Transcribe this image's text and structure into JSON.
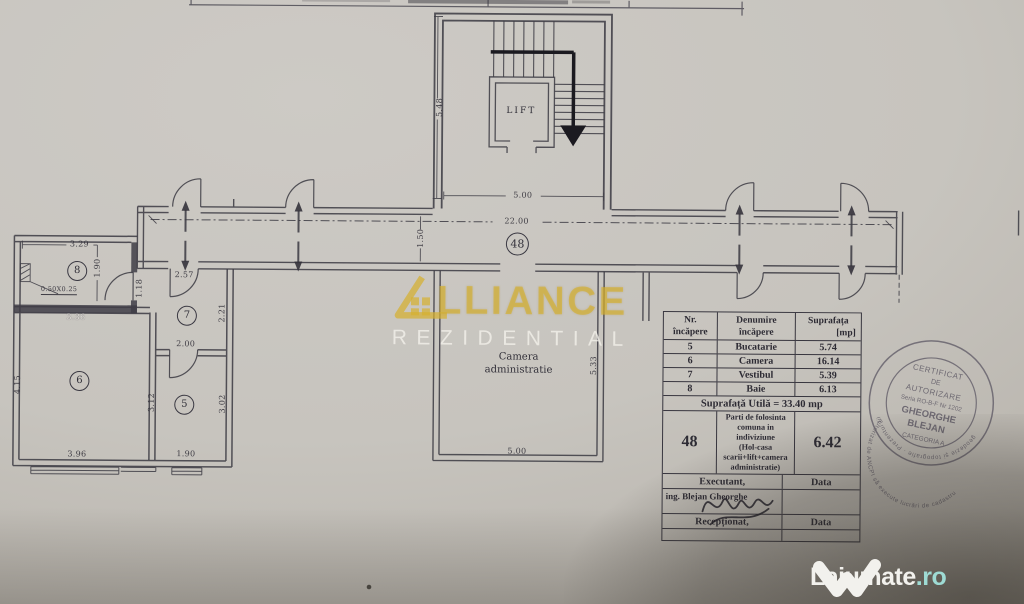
{
  "plan": {
    "lift_label": "LIFT",
    "common_number": "48",
    "admin_room": {
      "line1": "Camera",
      "line2": "administratie"
    },
    "rooms": {
      "r8": "8",
      "r7": "7",
      "r6": "6",
      "r5": "5"
    },
    "dims": {
      "stair_height": "5.48",
      "stair_width": "5.00",
      "corridor_length": "22.00",
      "corridor_width": "1.50",
      "admin_width": "5.00",
      "admin_height": "5.33",
      "r8_top": "3.29",
      "r8_side": "1.90",
      "r8_window": "0.50X0.25",
      "r8_bottom": "3.36",
      "r7_top": "2.57",
      "r7_left": "1.18",
      "r7_right": "2.21",
      "r7_bottom": "2.00",
      "r6_left": "4.15",
      "r6_bottom": "3.96",
      "r5_left": "3.12",
      "r5_right": "3.02",
      "r5_bottom": "1.90"
    }
  },
  "table": {
    "header": {
      "col1_line1": "Nr.",
      "col1_line2": "încăpere",
      "col2_line1": "Denumire",
      "col2_line2": "încăpere",
      "col3_line1": "Suprafața",
      "col3_line2": "[mp]"
    },
    "rows": [
      {
        "nr": "5",
        "name": "Bucatarie",
        "area": "5.74"
      },
      {
        "nr": "6",
        "name": "Camera",
        "area": "16.14"
      },
      {
        "nr": "7",
        "name": "Vestibul",
        "area": "5.39"
      },
      {
        "nr": "8",
        "name": "Baie",
        "area": "6.13"
      }
    ],
    "total": "Suprafață Utilă = 33.40 mp",
    "common": {
      "nr": "48",
      "desc_lines": [
        "Parti de folosinta",
        "comuna in",
        "indiviziune",
        "(Hol-casa",
        "scarii+lift+camera",
        "administratie)"
      ],
      "area": "6.42"
    },
    "footer": {
      "executant": "Executant,",
      "data_label1": "Data",
      "engineer": "ing. Blejan Gheorghe",
      "receptionat": "Recepționat,",
      "data_label2": "Data"
    }
  },
  "stamp": {
    "ring_top": "autorizat de ANCPI să execute lucrări de cadastru",
    "ring_bottom": "geodezie şi topografie · Prezentul fiind",
    "line1": "CERTIFICAT",
    "line2": "DE",
    "line3": "AUTORIZARE",
    "line4": "Seria RO-B-F Nr 1202",
    "line5": "GHEORGHE",
    "line6": "BLEJAN",
    "line7": "CATEGORIA A"
  },
  "watermark": {
    "brand_rest": "LLIANCE",
    "brand_sub": "REZIDENTIAL",
    "gold": "#d5b02f"
  },
  "site": {
    "name": "Lajumate",
    "tld": ".ro",
    "teal": "#9edbd4",
    "white": "#f2f1ed"
  }
}
